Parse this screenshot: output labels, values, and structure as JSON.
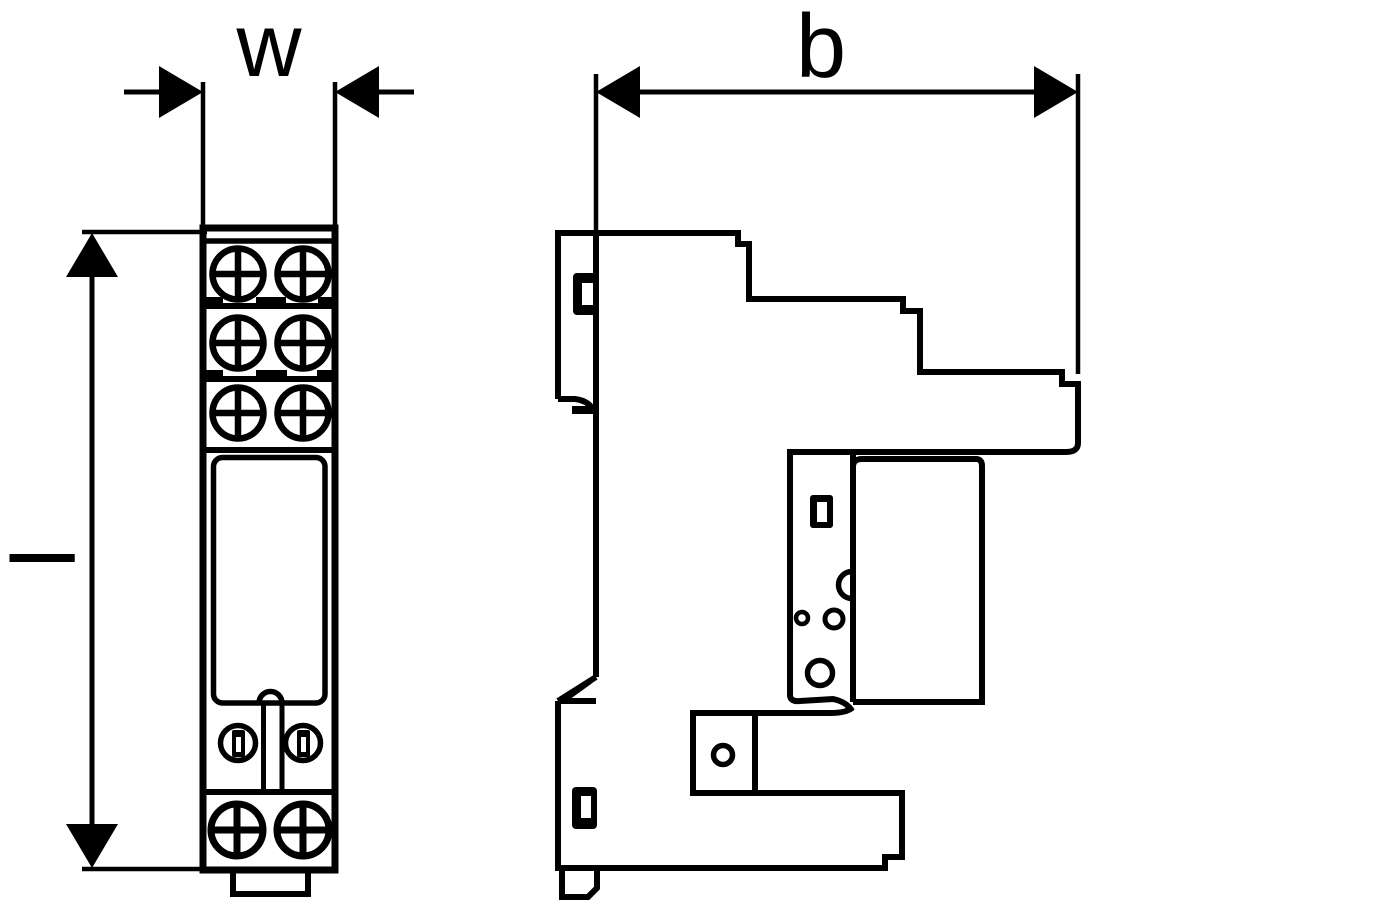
{
  "drawing": {
    "background": "#ffffff",
    "line_color": "#000000",
    "labels": {
      "w": "w",
      "b": "b",
      "l": "l"
    }
  }
}
